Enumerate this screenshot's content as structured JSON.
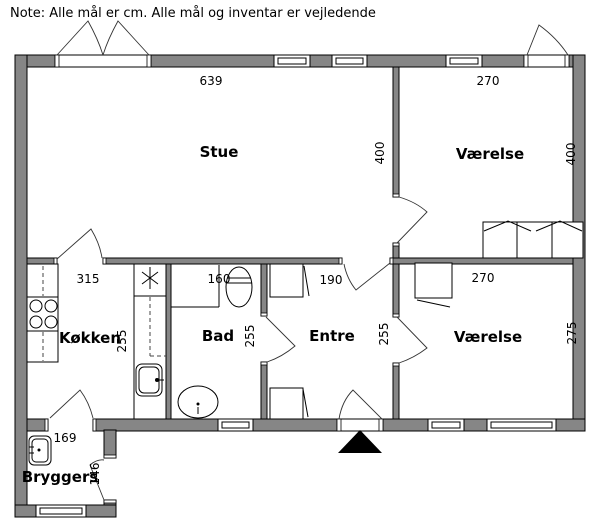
{
  "note": "Note: Alle mål er cm. Alle mål og inventar er vejledende",
  "rooms": {
    "stue": {
      "label": "Stue",
      "width_cm": "639",
      "depth_cm": "400"
    },
    "vaerelse_top": {
      "label": "Værelse",
      "width_cm": "270",
      "depth_cm": "400"
    },
    "koekken": {
      "label": "Køkken",
      "width_cm": "315",
      "depth_cm": "255"
    },
    "bad": {
      "label": "Bad",
      "width_cm": "160",
      "depth_cm": "255"
    },
    "entre": {
      "label": "Entre",
      "width_cm": "190",
      "depth_cm": "255"
    },
    "vaerelse_bottom": {
      "label": "Værelse",
      "width_cm": "270",
      "depth_cm": "275"
    },
    "bryggers": {
      "label": "Bryggers",
      "width_cm": "169",
      "depth_cm": "146"
    }
  },
  "colors": {
    "wall_fill": "#868686",
    "line": "#000000",
    "background": "#ffffff",
    "entrance_marker": "#000000"
  },
  "fixtures": [
    "stove-icon",
    "kitchen-sink-icon",
    "extractor-asterisk-icon",
    "shower-corner-icon",
    "toilet-icon",
    "washbasin-icon",
    "wardrobe-icon",
    "bed-icon",
    "utility-sink-icon",
    "entrance-arrow-icon",
    "window-icon",
    "door-swing-icon"
  ]
}
